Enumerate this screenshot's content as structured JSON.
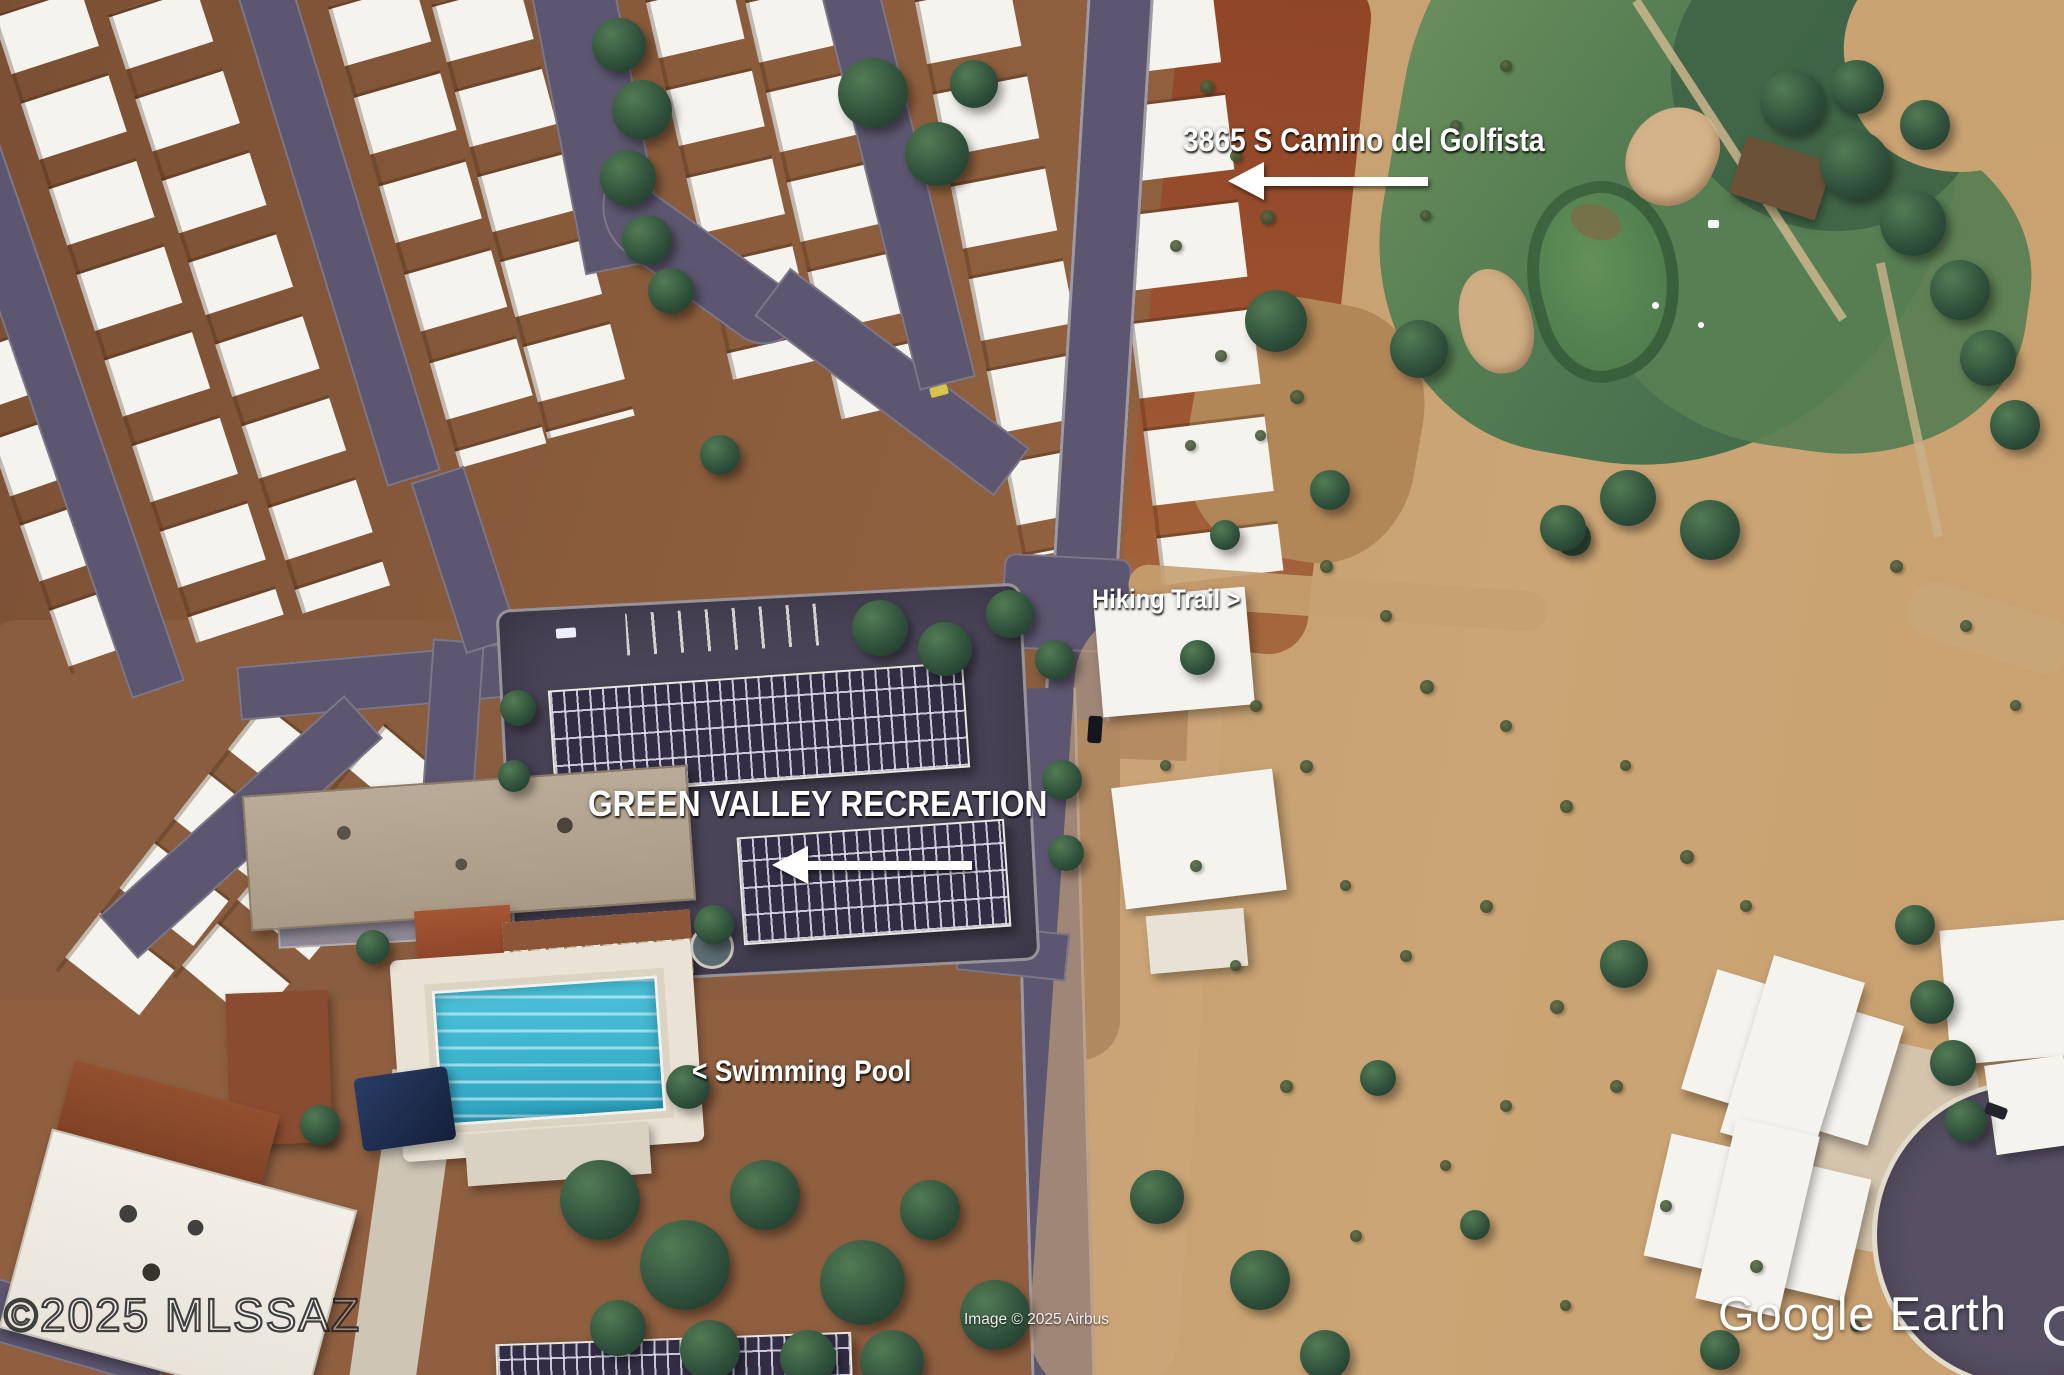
{
  "map": {
    "annotations": {
      "address": {
        "text": "3865 S Camino del Golfista"
      },
      "hiking_trail": {
        "text": "Hiking Trail >"
      },
      "recreation": {
        "text": "GREEN VALLEY RECREATION"
      },
      "swimming_pool": {
        "text": "< Swimming Pool"
      }
    },
    "watermark": {
      "text": "©2025 MLSSAZ"
    },
    "attribution": {
      "text": "Image © 2025 Airbus"
    },
    "logo": {
      "text": "Google Earth"
    },
    "icons": {
      "address_arrow": "left-arrow-icon",
      "recreation_arrow": "left-arrow-icon"
    },
    "colors": {
      "annotation_text": "#ffffff",
      "road_asphalt": "#5d5670",
      "desert_tan": "#c49c6e",
      "residential_dirt": "#84573a",
      "red_dirt": "#96502e",
      "golf_green": "#4e7950",
      "golf_green_bright": "#5c8a55",
      "bunker_sand": "#d2b288",
      "pool_water": "#3fb6cf",
      "roof_white": "#f5f3ee",
      "tree_green": "#2c4c38",
      "parking_asphalt": "#4a4458",
      "solar_panel": "#322d45"
    }
  }
}
